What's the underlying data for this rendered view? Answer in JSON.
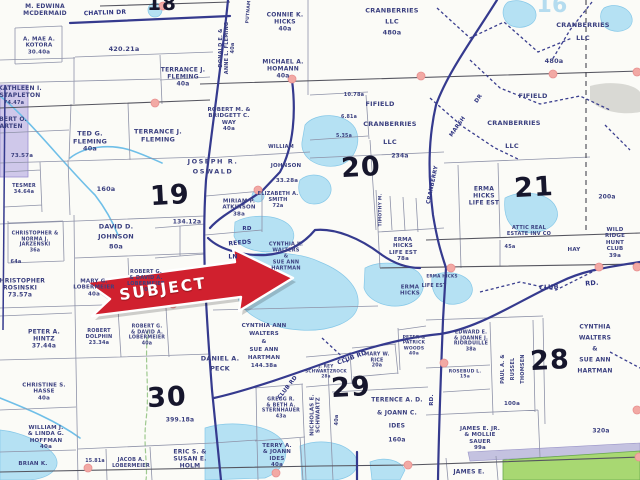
{
  "map": {
    "subject_label": "SUBJECT",
    "colors": {
      "accent_red": "#d0202e",
      "road_navy": "#353a8e",
      "water_blue": "#b5e1f3",
      "green_parcel": "#a8d872",
      "lavender_parcel": "#cfc8ea",
      "dot_pink": "#f2a9a4"
    },
    "dots": [
      [
        163,
        6
      ],
      [
        155,
        103
      ],
      [
        292,
        79
      ],
      [
        421,
        76
      ],
      [
        553,
        74
      ],
      [
        637,
        72
      ],
      [
        258,
        190
      ],
      [
        173,
        304
      ],
      [
        451,
        268
      ],
      [
        599,
        267
      ],
      [
        637,
        267
      ],
      [
        444,
        363
      ],
      [
        637,
        410
      ],
      [
        88,
        468
      ],
      [
        276,
        473
      ],
      [
        408,
        465
      ],
      [
        639,
        457
      ]
    ],
    "labels": [
      {
        "text": "M. EDWINA\nMCDERMAID",
        "x": 45,
        "y": 10,
        "fs": 6
      },
      {
        "text": "CHATLIN  DR",
        "x": 105,
        "y": 13,
        "fs": 6,
        "rot": -2,
        "cls": "road"
      },
      {
        "text": "A. MAE A.\nKOTORA\n30.40a",
        "x": 39,
        "y": 46,
        "fs": 5.5
      },
      {
        "text": "420.21a",
        "x": 124,
        "y": 50,
        "fs": 6.5
      },
      {
        "text": "TERRANCE J.\nFLEMING\n40a",
        "x": 183,
        "y": 77,
        "fs": 6
      },
      {
        "text": "DONALD E. &\nANNE L. FLEMING\n40a",
        "x": 228,
        "y": 48,
        "fs": 5,
        "rot": -90
      },
      {
        "text": "PUTNAM",
        "x": 249,
        "y": 12,
        "fs": 4.5,
        "rot": -85
      },
      {
        "text": "CONNIE K.\nHICKS\n40a",
        "x": 285,
        "y": 22,
        "fs": 6
      },
      {
        "text": "MICHAEL A.\nHOMANN\n40a",
        "x": 283,
        "y": 69,
        "fs": 6
      },
      {
        "text": "CRANBERRIES\nLLC\n480a",
        "x": 392,
        "y": 22,
        "fs": 6.5,
        "lh": 1.7
      },
      {
        "text": "CRANBERRIES\nLLC",
        "x": 583,
        "y": 32,
        "fs": 6.5,
        "lh": 2
      },
      {
        "text": "480a",
        "x": 554,
        "y": 62,
        "fs": 6.5
      },
      {
        "text": "FIFIELD",
        "x": 380,
        "y": 105,
        "fs": 6.5
      },
      {
        "text": "CRANBERRIES",
        "x": 390,
        "y": 125,
        "fs": 6.5
      },
      {
        "text": "LLC",
        "x": 390,
        "y": 143,
        "fs": 6.5
      },
      {
        "text": "234a",
        "x": 400,
        "y": 156,
        "fs": 6
      },
      {
        "text": "FIFIELD",
        "x": 533,
        "y": 97,
        "fs": 6.5
      },
      {
        "text": "CRANBERRIES",
        "x": 514,
        "y": 124,
        "fs": 6.5
      },
      {
        "text": "LLC",
        "x": 512,
        "y": 147,
        "fs": 6.5
      },
      {
        "text": "KATHLEEN I.\nSTAPLETON",
        "x": 20,
        "y": 92,
        "fs": 6
      },
      {
        "text": "74.47a",
        "x": 14,
        "y": 104,
        "fs": 5
      },
      {
        "text": "ROBERT O.\nMARTEN",
        "x": 8,
        "y": 123,
        "fs": 6
      },
      {
        "text": "TED G.\nFLEMING\n40a",
        "x": 90,
        "y": 142,
        "fs": 6.5
      },
      {
        "text": "TERRANCE J.\nFLEMING",
        "x": 158,
        "y": 136,
        "fs": 6.5
      },
      {
        "text": "ROBERT M. &\nBRIDGETT C.\nWAY\n40a",
        "x": 229,
        "y": 120,
        "fs": 5.5
      },
      {
        "text": "JOSEPH R.\nOSWALD",
        "x": 213,
        "y": 167,
        "fs": 6.5,
        "ls": 1.5,
        "lh": 1.6
      },
      {
        "text": "73.57a",
        "x": 22,
        "y": 156,
        "fs": 5.5
      },
      {
        "text": "TESMER\n34.64a",
        "x": 24,
        "y": 190,
        "fs": 5
      },
      {
        "text": "160a",
        "x": 106,
        "y": 190,
        "fs": 6.5
      },
      {
        "text": "19",
        "x": 170,
        "y": 196,
        "fs": 27,
        "cls": "sec",
        "rot": -3
      },
      {
        "text": "DAVID D.\nJOHNSON\n80a",
        "x": 116,
        "y": 237,
        "fs": 6.5,
        "lh": 1.5
      },
      {
        "text": "134.12a",
        "x": 187,
        "y": 222,
        "fs": 6
      },
      {
        "text": "CHRISTOPHER &\nNORMA J.\nJARZENSKI\n36a",
        "x": 35,
        "y": 243,
        "fs": 4.8
      },
      {
        "text": "64a",
        "x": 16,
        "y": 263,
        "fs": 5
      },
      {
        "text": "CHRISTOPHER\nROSINSKI\n73.57a",
        "x": 20,
        "y": 288,
        "fs": 6
      },
      {
        "text": "MARY G.\nLOBERMEIER\n40a",
        "x": 94,
        "y": 288,
        "fs": 5.5
      },
      {
        "text": "ROBERT G.\n& DAVID A.\nLOBERMEIER\n40a",
        "x": 146,
        "y": 282,
        "fs": 5
      },
      {
        "text": "PETER A.\nHINTZ\n37.44a",
        "x": 44,
        "y": 339,
        "fs": 6
      },
      {
        "text": "ROBERT\nDOLPHIN\n23.34a",
        "x": 99,
        "y": 338,
        "fs": 5
      },
      {
        "text": "ROBERT G.\n& DAVID A.\nLOBERMEIER\n40a",
        "x": 147,
        "y": 336,
        "fs": 4.8
      },
      {
        "text": "CHRISTINE S.\nHASSE\n40a",
        "x": 44,
        "y": 392,
        "fs": 5.5
      },
      {
        "text": "WILLIAM J.\n& LINDA G.\nHOFFMAN\n40a",
        "x": 46,
        "y": 438,
        "fs": 5.5
      },
      {
        "text": "BRIAN K.",
        "x": 33,
        "y": 464,
        "fs": 5.5
      },
      {
        "text": "30",
        "x": 167,
        "y": 398,
        "fs": 27,
        "cls": "sec",
        "rot": -3
      },
      {
        "text": "DANIEL A.\nPECK",
        "x": 220,
        "y": 364,
        "fs": 6.5,
        "lh": 1.6
      },
      {
        "text": "399.18a",
        "x": 180,
        "y": 420,
        "fs": 6
      },
      {
        "text": "15.81a",
        "x": 95,
        "y": 462,
        "fs": 4.8
      },
      {
        "text": "JACOB A.\nLOBERMEIER",
        "x": 131,
        "y": 464,
        "fs": 5
      },
      {
        "text": "ERIC S. &\nSUSAN E.\nHOLM",
        "x": 190,
        "y": 459,
        "fs": 6
      },
      {
        "text": "TERRY A.\n& JOANN\nIDES\n40a",
        "x": 277,
        "y": 456,
        "fs": 5.5
      },
      {
        "text": "MIRIAM P.\nATKINSON\n38a",
        "x": 239,
        "y": 208,
        "fs": 5.5
      },
      {
        "text": "ELIZABETH A.\nSMITH\n72a",
        "x": 278,
        "y": 201,
        "fs": 5
      },
      {
        "text": "WILLIAM",
        "x": 281,
        "y": 148,
        "fs": 5
      },
      {
        "text": "JOHNSON",
        "x": 286,
        "y": 166,
        "fs": 5.5
      },
      {
        "text": "33.28a",
        "x": 287,
        "y": 181,
        "fs": 5.5
      },
      {
        "text": "10.78a",
        "x": 354,
        "y": 96,
        "fs": 5
      },
      {
        "text": "6.81a",
        "x": 349,
        "y": 118,
        "fs": 4.8
      },
      {
        "text": "5.35a",
        "x": 344,
        "y": 137,
        "fs": 4.8
      },
      {
        "text": "20",
        "x": 361,
        "y": 168,
        "fs": 27,
        "cls": "sec",
        "rot": -3
      },
      {
        "text": "RD",
        "x": 247,
        "y": 229,
        "fs": 5.5,
        "cls": "road"
      },
      {
        "text": "REEDS",
        "x": 240,
        "y": 243,
        "fs": 6,
        "rot": -5,
        "cls": "road"
      },
      {
        "text": "LN",
        "x": 233,
        "y": 257,
        "fs": 6,
        "cls": "road"
      },
      {
        "text": "CYNTHIA K.\nWALTERS\n&\nSUE ANN\nHARTMAN",
        "x": 286,
        "y": 257,
        "fs": 5
      },
      {
        "text": "ERMA\nHICKS\nLIFE EST\n78a",
        "x": 403,
        "y": 250,
        "fs": 5.5
      },
      {
        "text": "ERMA\nHICKS",
        "x": 410,
        "y": 291,
        "fs": 5.5
      },
      {
        "text": "LIFE EST",
        "x": 434,
        "y": 287,
        "fs": 4.8
      },
      {
        "text": "ERMA HICKS",
        "x": 442,
        "y": 277,
        "fs": 4.2
      },
      {
        "text": "ERMA\nHICKS\nLIFE EST",
        "x": 484,
        "y": 196,
        "fs": 6
      },
      {
        "text": "TIMOTHY M.",
        "x": 381,
        "y": 210,
        "fs": 4.5,
        "rot": -90
      },
      {
        "text": "21",
        "x": 534,
        "y": 188,
        "fs": 27,
        "cls": "sec",
        "rot": -3
      },
      {
        "text": "200a",
        "x": 607,
        "y": 197,
        "fs": 6
      },
      {
        "text": "ATTIC REAL\nESTATE INV CO",
        "x": 529,
        "y": 232,
        "fs": 5
      },
      {
        "text": "45a",
        "x": 510,
        "y": 248,
        "fs": 5
      },
      {
        "text": "WILD RIDGE\nHUNT CLUB\n39a",
        "x": 615,
        "y": 243,
        "fs": 5.5
      },
      {
        "text": "HAY",
        "x": 574,
        "y": 250,
        "fs": 5.5
      },
      {
        "text": "CRANBERRY",
        "x": 433,
        "y": 185,
        "fs": 5.5,
        "rot": -78,
        "cls": "road"
      },
      {
        "text": "MARSH",
        "x": 458,
        "y": 127,
        "fs": 5.5,
        "rot": -55,
        "cls": "road"
      },
      {
        "text": "DR",
        "x": 479,
        "y": 99,
        "fs": 5.5,
        "rot": -55,
        "cls": "road"
      },
      {
        "text": "CLUB",
        "x": 549,
        "y": 288,
        "fs": 6.5,
        "rot": -4,
        "cls": "road"
      },
      {
        "text": "RD.",
        "x": 592,
        "y": 284,
        "fs": 6.5,
        "rot": -4,
        "cls": "road"
      },
      {
        "text": "CLUB RD",
        "x": 352,
        "y": 358,
        "fs": 6,
        "rot": -20,
        "cls": "road"
      },
      {
        "text": "CLUB RD",
        "x": 288,
        "y": 388,
        "fs": 5.5,
        "rot": -52,
        "cls": "road"
      },
      {
        "text": "RD.",
        "x": 432,
        "y": 400,
        "fs": 5.5,
        "rot": -90,
        "cls": "road"
      },
      {
        "text": "CYNTHIA ANN\nWALTERS\n&\nSUE ANN\nHARTMAN\n144.38a",
        "x": 264,
        "y": 347,
        "fs": 5.5,
        "lh": 1.45
      },
      {
        "text": "29",
        "x": 351,
        "y": 388,
        "fs": 27,
        "cls": "sec",
        "rot": -3
      },
      {
        "text": "GREGG R.\n& BETH A.\nSTERNHAUER\n43a",
        "x": 281,
        "y": 409,
        "fs": 4.8
      },
      {
        "text": "NICHOLAS E.\nSCHWARTZ",
        "x": 316,
        "y": 415,
        "fs": 5.5,
        "rot": -90
      },
      {
        "text": "40a",
        "x": 338,
        "y": 420,
        "fs": 5,
        "rot": -90
      },
      {
        "text": "J. REY\nSCHWARTZROCK\n28a",
        "x": 326,
        "y": 372,
        "fs": 4.2
      },
      {
        "text": "MARY W.\nRICE\n20a",
        "x": 377,
        "y": 361,
        "fs": 4.8
      },
      {
        "text": "PETER &\nPATRICK\nWOODS\n40a",
        "x": 414,
        "y": 346,
        "fs": 4.5
      },
      {
        "text": "TERENCE A. D.\n& JOANN C.\nIDES\n160a",
        "x": 397,
        "y": 420,
        "fs": 6,
        "lh": 2.2
      },
      {
        "text": "EDWARD E.\n& JOANNE J.\nRIORDUILLE\n38a",
        "x": 471,
        "y": 342,
        "fs": 4.8
      },
      {
        "text": "ROSEBUD L.\n15a",
        "x": 465,
        "y": 375,
        "fs": 4.5
      },
      {
        "text": "PAUL A. &\nRUSSEL\nTHOMSEN",
        "x": 513,
        "y": 369,
        "fs": 5,
        "rot": -90,
        "lh": 2
      },
      {
        "text": "100a",
        "x": 512,
        "y": 404,
        "fs": 5.5
      },
      {
        "text": "28",
        "x": 550,
        "y": 361,
        "fs": 27,
        "cls": "sec",
        "rot": -3
      },
      {
        "text": "CYNTHIA\nWALTERS\n&\nSUE ANN\nHARTMAN",
        "x": 595,
        "y": 349,
        "fs": 6,
        "lh": 1.85
      },
      {
        "text": "320a",
        "x": 601,
        "y": 431,
        "fs": 6
      },
      {
        "text": "JAMES E. JR.\n& MOLLIE\nSAUER\n99a",
        "x": 480,
        "y": 439,
        "fs": 5.5
      },
      {
        "text": "JAMES E.",
        "x": 469,
        "y": 472,
        "fs": 6
      },
      {
        "text": "16",
        "x": 552,
        "y": 6,
        "fs": 22,
        "cls": "pale"
      },
      {
        "text": "18",
        "x": 162,
        "y": 4,
        "fs": 20,
        "cls": "sec"
      }
    ]
  }
}
